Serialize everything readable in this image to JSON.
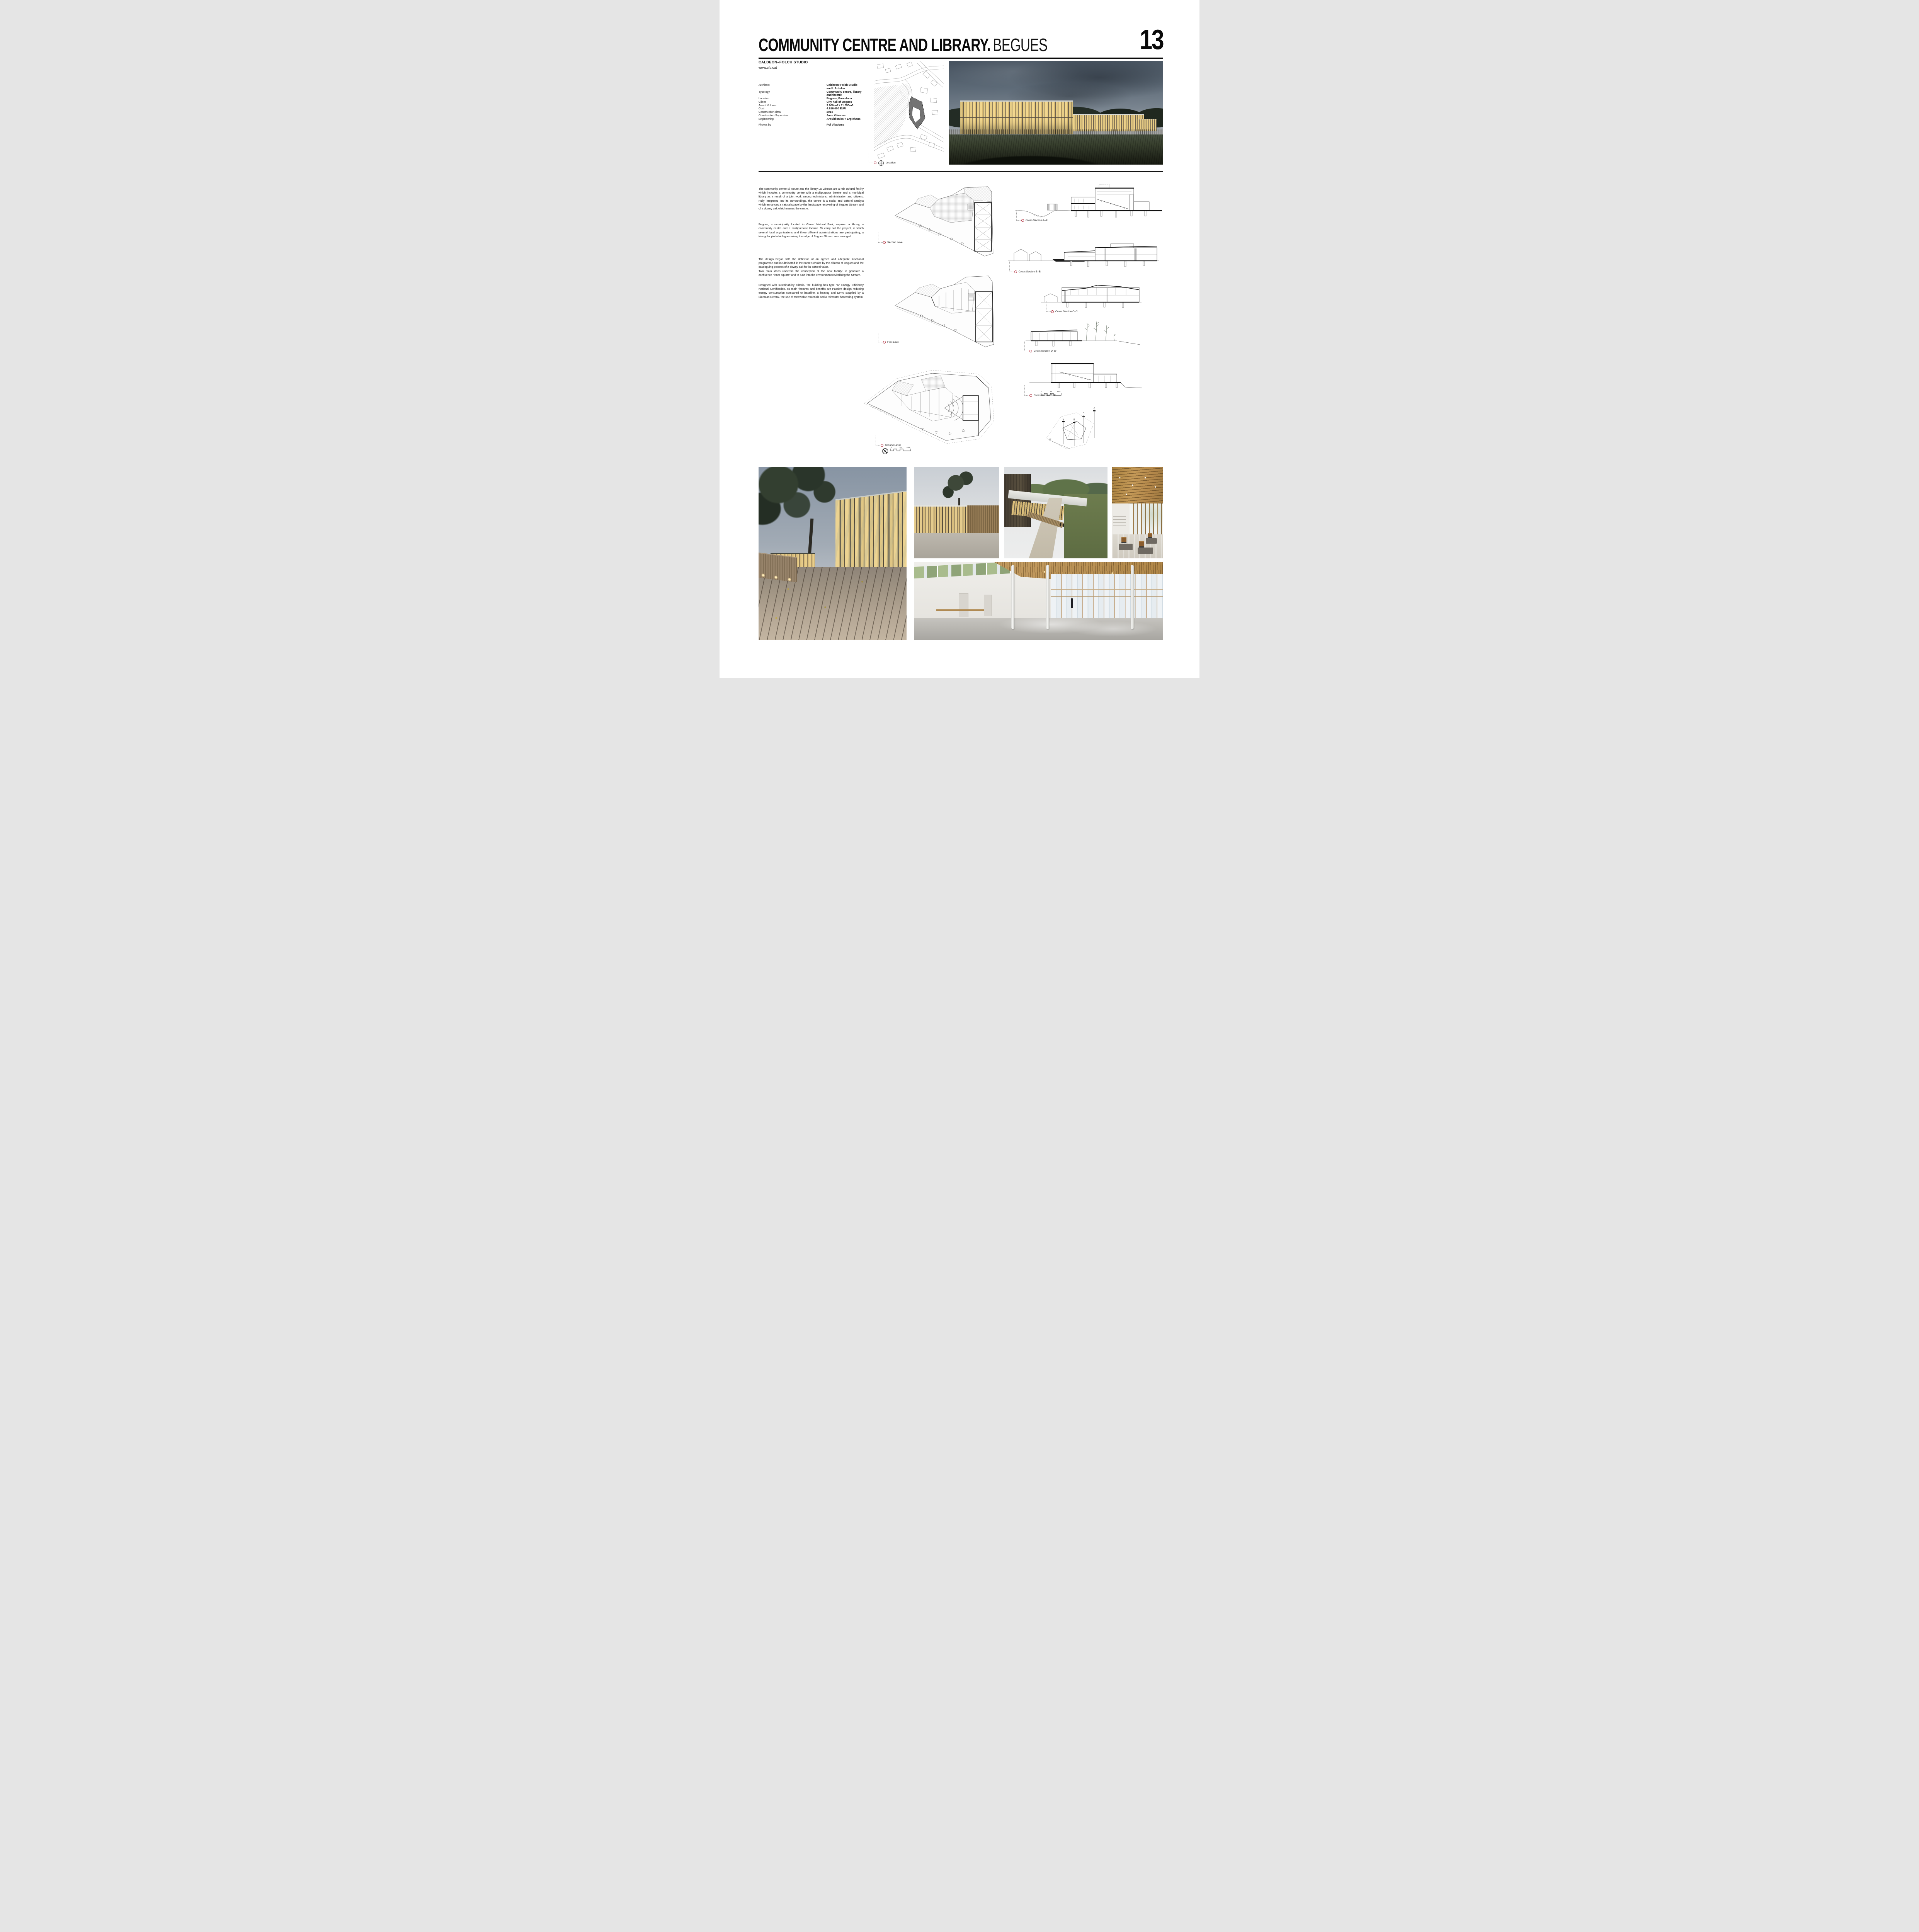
{
  "header": {
    "number": "13",
    "title_bold": "COMMUNITY CENTRE AND LIBRARY.",
    "title_city": "BEGUES"
  },
  "studio": {
    "name": "CALDEON–FOLCH STUDIO",
    "website": "www.cfs.cat"
  },
  "info": {
    "rows": [
      {
        "label": "Architect",
        "value": "Calderon–Folch Studio"
      },
      {
        "label": "",
        "value": "and I. Arbeloa"
      },
      {
        "label": "Typology",
        "value": "Community centre, library"
      },
      {
        "label": "",
        "value": "and theatre"
      },
      {
        "label": "Location",
        "value": "Begues, Barcelona"
      },
      {
        "label": "Client",
        "value": "City hall of Begues"
      },
      {
        "label": "Area / Volume",
        "value": "3.900 m2 / 11.050m3"
      },
      {
        "label": "Cost",
        "value": "4.616.000 EUR"
      },
      {
        "label": "Construction data",
        "value": "2014"
      },
      {
        "label": "Construction Supervisor",
        "value": "Joan Vilanova"
      },
      {
        "label": "Engineering",
        "value": "Arquitècnics + Ergiehaus"
      },
      {
        "label": "Photos by",
        "value": "Pol Viladoms"
      }
    ]
  },
  "paragraphs": [
    "The community centre El Roure and the library La Ginesta are a mix cultural facility which includes a community centre with a multipurpose theatre and a municipal library as a result of a joint work among technicians, administration and citizens. Fully integrated into its surroundings, the centre is a social and cultural catalyst which enhances a natural space by the landscape recovering of Begues Stream and of a downy oak which names the centre.",
    "Begues, a municipality located in Garraf Natural Park, required a library, a community centre and a multipurpose theatre. To carry out the project, in which several local organisations and three different administrations are participating, a triangular plot which goes along the edge of Begues Stream was arranged.",
    "The design began with the definition of an agreed and adequate functional programme and it culminated in the name's choice by the citizens of Begues and the cataloguing process of a downy oak for its cultural value.",
    "Two main ideas underpin the conception of the new facility: to generate a confluence “inner square” and to tune into the environment revitalising the Stream.",
    "Designed with sustainability criteria, the building has type “A” Energy Efficiency National Certification. Its main features and benefits are Passive design reducing energy consumption compared to baseline, a heating and DHW supplied by a Biomass Central, the use of renewable materials and a rainwater harvesting system."
  ],
  "drawings": {
    "location_label": "Location",
    "plan_labels": [
      "Second Level",
      "First Level",
      "Ground Level"
    ],
    "section_labels": [
      "Cross Section A–A'",
      "Cross Section B–B'",
      "Cross Section C–C'",
      "Cross Section D–D'",
      "Cross Section E–E'"
    ],
    "scalebar": {
      "start": "0",
      "mid": "20",
      "end": "40m"
    },
    "site_key_letters": [
      "A",
      "B",
      "C",
      "D",
      "E'"
    ]
  },
  "colors": {
    "accent": "#b02a3a",
    "ink": "#111111"
  }
}
